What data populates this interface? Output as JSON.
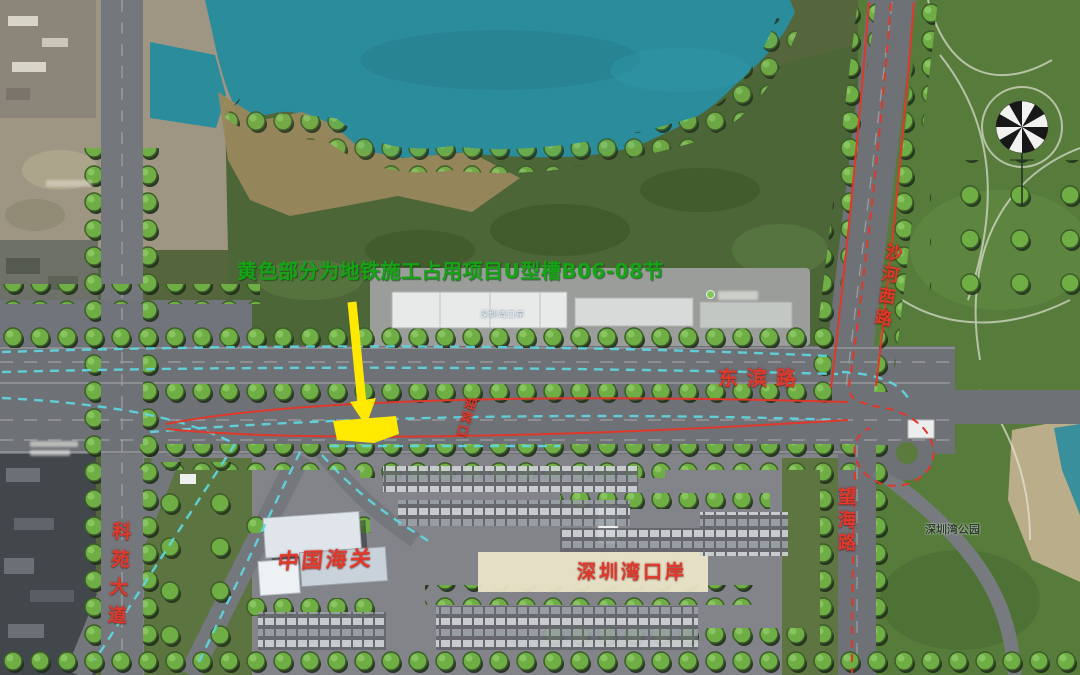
{
  "map": {
    "annotation": {
      "text": "黄色部分为地铁施工占用项目U型槽B06-08节",
      "color": "#16a316"
    },
    "highlight": {
      "description": "U型槽B06-08节",
      "color": "#ffe900"
    },
    "road_labels": {
      "dongbin": "东滨路",
      "shahexi": "沙河西路",
      "wanghai": "望海路",
      "keyuan": "科苑大道",
      "gate": "迎宾口"
    },
    "place_labels": {
      "customs": "中国海关",
      "port": "深圳湾口岸",
      "bay_park": "深圳湾公园",
      "port_basemap": "深圳湾口岸"
    },
    "colors": {
      "label_red": "#e0392b",
      "annotation_green": "#16a316",
      "highlight_yellow": "#ffe900",
      "dash_cyan": "#5fd9e4",
      "route_red": "#df382b",
      "water_teal": "#2b8c9c"
    }
  }
}
